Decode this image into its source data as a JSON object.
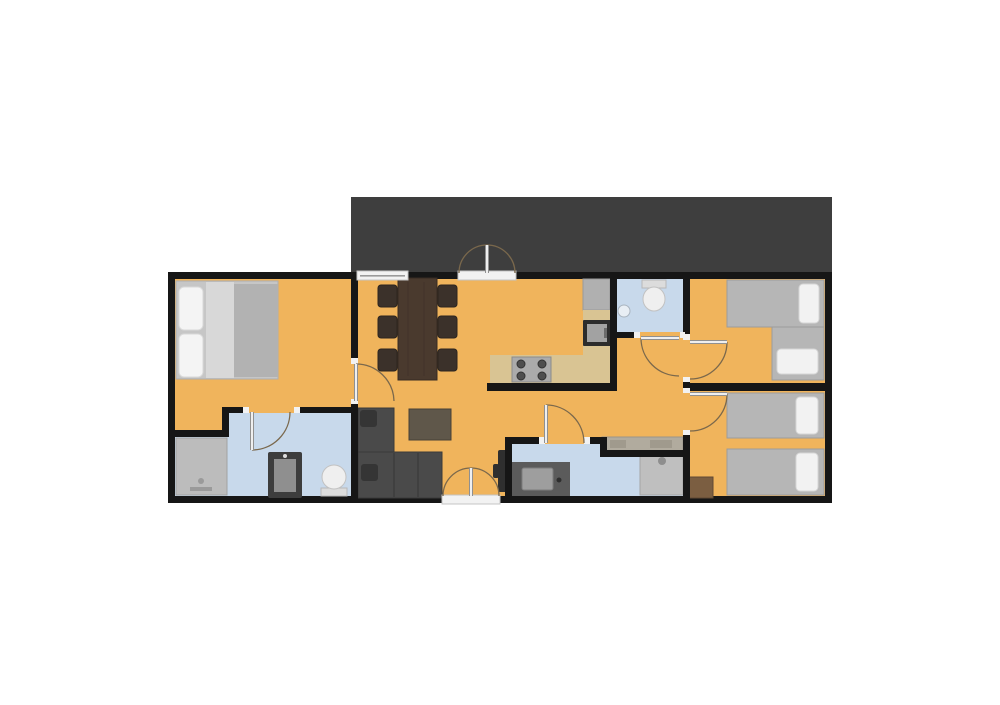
{
  "canvas": {
    "width": 1000,
    "height": 705,
    "background": "#ffffff"
  },
  "palette": {
    "wall": "#161616",
    "floor": "#f0b45c",
    "bathroom_floor": "#c8d9eb",
    "terrace": "#3e3e3e",
    "window": "#f2f2f2",
    "door_arc": "#7a684c",
    "door_leaf": "#efefef",
    "door_leaf_casing": "#909090",
    "bed_mattress": "#b6b6b6",
    "pillow": "#f2f2f2",
    "sofa": "#4a4a4a",
    "table_wood": "#4a3a2e",
    "counter": "#d9c493"
  },
  "base": [
    {
      "name": "terrace",
      "rect": [
        351,
        197,
        481,
        76
      ],
      "fill": "#3e3e3e"
    },
    {
      "name": "building-outline",
      "rect": [
        168,
        272,
        664,
        231
      ],
      "fill": "#161616"
    },
    {
      "name": "floor-main",
      "rect": [
        175,
        279,
        650,
        217
      ],
      "fill": "#f0b45c"
    },
    {
      "name": "floor-bathroom-left",
      "rect": [
        229,
        413,
        124,
        83
      ],
      "fill": "#c8d9eb"
    },
    {
      "name": "floor-bathroom-left-shower-area",
      "rect": [
        175,
        437,
        54,
        59
      ],
      "fill": "#c8d9eb"
    },
    {
      "name": "floor-bathroom-top",
      "rect": [
        617,
        279,
        66,
        53
      ],
      "fill": "#c8d9eb"
    },
    {
      "name": "floor-bathroom-bottom-left",
      "rect": [
        512,
        444,
        95,
        52
      ],
      "fill": "#c8d9eb"
    },
    {
      "name": "floor-bathroom-bottom-right",
      "rect": [
        607,
        457,
        76,
        39
      ],
      "fill": "#c8d9eb"
    }
  ],
  "walls": [
    [
      351,
      272,
      7,
      92
    ],
    [
      351,
      400,
      7,
      103
    ],
    [
      175,
      430,
      54,
      7
    ],
    [
      222,
      407,
      7,
      30
    ],
    [
      229,
      407,
      20,
      6
    ],
    [
      294,
      407,
      64,
      6
    ],
    [
      610,
      272,
      7,
      118
    ],
    [
      487,
      383,
      130,
      8
    ],
    [
      617,
      332,
      23,
      6
    ],
    [
      680,
      332,
      10,
      6
    ],
    [
      683,
      272,
      7,
      68
    ],
    [
      683,
      377,
      7,
      16
    ],
    [
      683,
      430,
      7,
      73
    ],
    [
      690,
      383,
      142,
      8
    ],
    [
      505,
      437,
      7,
      66
    ],
    [
      505,
      437,
      40,
      7
    ],
    [
      584,
      437,
      23,
      7
    ],
    [
      600,
      437,
      7,
      20
    ],
    [
      600,
      450,
      90,
      7
    ]
  ],
  "furniture": [
    {
      "name": "double-bed-frame",
      "rect": [
        176,
        281,
        102,
        98
      ],
      "fill": "#c6c6c6",
      "stroke": "#aeaeae"
    },
    {
      "name": "double-bed-sheet",
      "rect": [
        206,
        282,
        28,
        96
      ],
      "fill": "#d8d8d8"
    },
    {
      "name": "double-bed-blanket",
      "rect": [
        234,
        284,
        44,
        93
      ],
      "fill": "#b2b2b2"
    },
    {
      "name": "double-bed-pillow",
      "rect": [
        179,
        287,
        24,
        43
      ],
      "fill": "#f4f4f4",
      "stroke": "#d8d8d8",
      "rx": 5
    },
    {
      "name": "double-bed-pillow",
      "rect": [
        179,
        334,
        24,
        43
      ],
      "fill": "#f4f4f4",
      "stroke": "#d8d8d8",
      "rx": 5
    },
    {
      "name": "shower",
      "rect": [
        176,
        438,
        51,
        57
      ],
      "fill": "#bcbcbc",
      "stroke": "#a2a2a2"
    },
    {
      "name": "shower-faucet",
      "rect": [
        190,
        487,
        22,
        4
      ],
      "fill": "#9a9a9a"
    },
    {
      "name": "shower-drain",
      "circle": [
        201,
        481,
        3
      ],
      "fill": "#9a9a9a"
    },
    {
      "name": "washing-machine",
      "rect": [
        268,
        452,
        34,
        46
      ],
      "fill": "#3d3d3d",
      "rx": 2
    },
    {
      "name": "washing-machine-door",
      "rect": [
        274,
        459,
        22,
        33
      ],
      "fill": "#8f8f8f"
    },
    {
      "name": "washing-machine-knob",
      "circle": [
        285,
        456,
        2
      ],
      "fill": "#dddddd"
    },
    {
      "name": "toilet-tank",
      "rect": [
        321,
        488,
        26,
        8
      ],
      "fill": "#dcdcdc",
      "stroke": "#b8b8b8"
    },
    {
      "name": "toilet-bowl",
      "ellipse": [
        334,
        477,
        12,
        12
      ],
      "fill": "#efefef",
      "stroke": "#c2c2c2"
    },
    {
      "name": "dining-table",
      "rect": [
        398,
        278,
        39,
        102
      ],
      "fill": "#4a3a2e",
      "stroke": "#372b22"
    },
    {
      "name": "dining-table-grain",
      "line": [
        408,
        282,
        408,
        376
      ],
      "stroke": "#41332a",
      "sw": 1
    },
    {
      "name": "dining-table-grain",
      "line": [
        424,
        282,
        424,
        376
      ],
      "stroke": "#41332a",
      "sw": 1
    },
    {
      "name": "dining-chair",
      "rect": [
        378,
        285,
        19,
        22
      ],
      "fill": "#3b312a",
      "stroke": "#2c251f",
      "rx": 3
    },
    {
      "name": "dining-chair",
      "rect": [
        378,
        316,
        19,
        22
      ],
      "fill": "#3b312a",
      "stroke": "#2c251f",
      "rx": 3
    },
    {
      "name": "dining-chair",
      "rect": [
        378,
        349,
        19,
        22
      ],
      "fill": "#3b312a",
      "stroke": "#2c251f",
      "rx": 3
    },
    {
      "name": "dining-chair",
      "rect": [
        438,
        285,
        19,
        22
      ],
      "fill": "#3b312a",
      "stroke": "#2c251f",
      "rx": 3
    },
    {
      "name": "dining-chair",
      "rect": [
        438,
        316,
        19,
        22
      ],
      "fill": "#3b312a",
      "stroke": "#2c251f",
      "rx": 3
    },
    {
      "name": "dining-chair",
      "rect": [
        438,
        349,
        19,
        22
      ],
      "fill": "#3b312a",
      "stroke": "#2c251f",
      "rx": 3
    },
    {
      "name": "kitchen-fridge",
      "rect": [
        583,
        279,
        27,
        31
      ],
      "fill": "#b0b0b0",
      "stroke": "#9a9a9a"
    },
    {
      "name": "kitchen-counter-side",
      "rect": [
        583,
        310,
        27,
        73
      ],
      "fill": "#d9c493"
    },
    {
      "name": "kitchen-counter",
      "rect": [
        490,
        355,
        120,
        28
      ],
      "fill": "#d9c493"
    },
    {
      "name": "oven",
      "rect": [
        583,
        320,
        28,
        26
      ],
      "fill": "#2c2c2c",
      "rx": 1
    },
    {
      "name": "oven-door",
      "rect": [
        587,
        324,
        20,
        18
      ],
      "fill": "#a2a2a2"
    },
    {
      "name": "oven-handle",
      "rect": [
        604,
        328,
        3,
        10
      ],
      "fill": "#6b6b6b"
    },
    {
      "name": "stove",
      "rect": [
        512,
        357,
        39,
        25
      ],
      "fill": "#ababab",
      "stroke": "#8b8b8b"
    },
    {
      "name": "stove-burner",
      "circle": [
        521,
        364,
        4
      ],
      "fill": "#4e4e4e",
      "stroke": "#333333"
    },
    {
      "name": "stove-burner",
      "circle": [
        542,
        364,
        4
      ],
      "fill": "#4e4e4e",
      "stroke": "#333333"
    },
    {
      "name": "stove-burner",
      "circle": [
        521,
        376,
        4
      ],
      "fill": "#4e4e4e",
      "stroke": "#333333"
    },
    {
      "name": "stove-burner",
      "circle": [
        542,
        376,
        4
      ],
      "fill": "#4e4e4e",
      "stroke": "#333333"
    },
    {
      "name": "toilet-tank",
      "rect": [
        642,
        280,
        24,
        8
      ],
      "fill": "#dcdcdc",
      "stroke": "#b8b8b8"
    },
    {
      "name": "toilet-bowl",
      "ellipse": [
        654,
        299,
        11,
        12
      ],
      "fill": "#efefef",
      "stroke": "#c2c2c2"
    },
    {
      "name": "hand-basin",
      "circle": [
        624,
        311,
        6
      ],
      "fill": "#e8eef4",
      "stroke": "#a9b4bf"
    },
    {
      "name": "hall-counter",
      "rect": [
        602,
        437,
        81,
        15
      ],
      "fill": "#b1ab9e",
      "stroke": "#9a948a"
    },
    {
      "name": "hall-counter-item",
      "rect": [
        610,
        440,
        16,
        8
      ],
      "fill": "#a09a8d"
    },
    {
      "name": "hall-counter-item",
      "rect": [
        650,
        440,
        22,
        8
      ],
      "fill": "#a09a8d"
    },
    {
      "name": "vanity",
      "rect": [
        512,
        462,
        58,
        34
      ],
      "fill": "#5b5b5b"
    },
    {
      "name": "vanity-sink",
      "rect": [
        522,
        468,
        31,
        22
      ],
      "fill": "#9e9e9e",
      "stroke": "#7c7c7c",
      "rx": 2
    },
    {
      "name": "vanity-faucet",
      "circle": [
        559,
        480,
        2.5
      ],
      "fill": "#2e2e2e"
    },
    {
      "name": "shower",
      "rect": [
        640,
        455,
        43,
        40
      ],
      "fill": "#bfbfbf",
      "stroke": "#a5a5a5"
    },
    {
      "name": "shower-head",
      "circle": [
        662,
        461,
        4
      ],
      "fill": "#8e8e8e"
    },
    {
      "name": "tv",
      "rect": [
        498,
        450,
        12,
        42
      ],
      "fill": "#2f2f2f",
      "rx": 2
    },
    {
      "name": "tv-stand",
      "rect": [
        493,
        464,
        6,
        14
      ],
      "fill": "#2f2f2f",
      "rx": 2
    },
    {
      "name": "sofa-chaise",
      "rect": [
        358,
        408,
        36,
        90
      ],
      "fill": "#4a4a4a",
      "stroke": "#3a3a3a"
    },
    {
      "name": "sofa-seat",
      "rect": [
        358,
        452,
        84,
        46
      ],
      "fill": "#4a4a4a",
      "stroke": "#3a3a3a"
    },
    {
      "name": "sofa-cushion-line",
      "line": [
        394,
        453,
        394,
        497
      ],
      "stroke": "#3c3c3c",
      "sw": 1.5
    },
    {
      "name": "sofa-cushion-line",
      "line": [
        418,
        453,
        418,
        497
      ],
      "stroke": "#3c3c3c",
      "sw": 1.5
    },
    {
      "name": "sofa-pillow",
      "rect": [
        360,
        410,
        17,
        17
      ],
      "fill": "#353535",
      "rx": 3
    },
    {
      "name": "sofa-pillow",
      "rect": [
        361,
        464,
        17,
        17
      ],
      "fill": "#353535",
      "rx": 3
    },
    {
      "name": "coffee-table",
      "rect": [
        409,
        409,
        42,
        31
      ],
      "fill": "#5f574a",
      "stroke": "#474136"
    },
    {
      "name": "single-bed",
      "rect": [
        727,
        280,
        97,
        47
      ],
      "fill": "#b6b6b6",
      "stroke": "#9c9c9c"
    },
    {
      "name": "bed-pillow",
      "rect": [
        799,
        284,
        20,
        39
      ],
      "fill": "#f2f2f2",
      "stroke": "#d5d5d5",
      "rx": 4
    },
    {
      "name": "single-bed",
      "rect": [
        772,
        327,
        52,
        53
      ],
      "fill": "#b6b6b6",
      "stroke": "#9c9c9c"
    },
    {
      "name": "bed-pillow",
      "rect": [
        777,
        349,
        41,
        25
      ],
      "fill": "#f2f2f2",
      "stroke": "#d5d5d5",
      "rx": 4
    },
    {
      "name": "single-bed",
      "rect": [
        727,
        393,
        97,
        45
      ],
      "fill": "#b6b6b6",
      "stroke": "#9c9c9c"
    },
    {
      "name": "bed-pillow",
      "rect": [
        796,
        397,
        22,
        37
      ],
      "fill": "#f2f2f2",
      "stroke": "#d5d5d5",
      "rx": 4
    },
    {
      "name": "single-bed",
      "rect": [
        727,
        449,
        97,
        46
      ],
      "fill": "#b6b6b6",
      "stroke": "#9c9c9c"
    },
    {
      "name": "bed-pillow",
      "rect": [
        796,
        453,
        22,
        38
      ],
      "fill": "#f2f2f2",
      "stroke": "#d5d5d5",
      "rx": 4
    },
    {
      "name": "nightstand",
      "rect": [
        688,
        477,
        25,
        21
      ],
      "fill": "#7b5e41",
      "stroke": "#5f4833"
    }
  ],
  "openings": [
    {
      "name": "window",
      "rect": [
        357,
        271,
        51,
        9
      ],
      "fill": "#f2f2f2",
      "stroke": "#c4c4c4"
    },
    {
      "name": "window-pane-line",
      "rect": [
        360,
        275,
        45,
        1.6
      ],
      "fill": "#9a9a9a"
    },
    {
      "name": "door-threshold",
      "rect": [
        458,
        271,
        58,
        9
      ],
      "fill": "#f2f2f2",
      "stroke": "#c4c4c4"
    },
    {
      "name": "door-threshold",
      "rect": [
        442,
        495,
        58,
        9
      ],
      "fill": "#f2f2f2",
      "stroke": "#c4c4c4"
    },
    {
      "name": "door-jamb",
      "rect": [
        351,
        358,
        7,
        6
      ],
      "fill": "#f2f2f2"
    },
    {
      "name": "door-jamb",
      "rect": [
        351,
        399,
        7,
        5
      ],
      "fill": "#f2f2f2"
    },
    {
      "name": "door-jamb",
      "rect": [
        243,
        407,
        6,
        6
      ],
      "fill": "#f2f2f2"
    },
    {
      "name": "door-jamb",
      "rect": [
        294,
        407,
        6,
        6
      ],
      "fill": "#f2f2f2"
    },
    {
      "name": "door-jamb",
      "rect": [
        539,
        437,
        6,
        7
      ],
      "fill": "#f2f2f2"
    },
    {
      "name": "door-jamb",
      "rect": [
        584,
        437,
        6,
        7
      ],
      "fill": "#f2f2f2"
    },
    {
      "name": "door-jamb",
      "rect": [
        634,
        332,
        6,
        6
      ],
      "fill": "#f2f2f2"
    },
    {
      "name": "door-jamb",
      "rect": [
        680,
        332,
        5,
        6
      ],
      "fill": "#f2f2f2"
    },
    {
      "name": "door-jamb",
      "rect": [
        683,
        334,
        7,
        6
      ],
      "fill": "#f2f2f2"
    },
    {
      "name": "door-jamb",
      "rect": [
        683,
        377,
        7,
        5
      ],
      "fill": "#f2f2f2"
    },
    {
      "name": "door-jamb",
      "rect": [
        683,
        388,
        7,
        5
      ],
      "fill": "#f2f2f2"
    },
    {
      "name": "door-jamb",
      "rect": [
        683,
        430,
        7,
        5
      ],
      "fill": "#f2f2f2"
    }
  ],
  "doors": [
    {
      "name": "terrace-french-door",
      "leaf": [
        487,
        245,
        487,
        273
      ],
      "arc": "M459,273 A28,28 0 0 1 515,273"
    },
    {
      "name": "living-room-garden-door",
      "leaf": [
        471,
        468,
        471,
        496
      ],
      "arc": "M443,496 A28,28 0 0 1 499,496"
    },
    {
      "name": "bedroom-left-door",
      "leaf": [
        356,
        364,
        356,
        401
      ],
      "arc": "M356,364 A38,38 0 0 1 394,401"
    },
    {
      "name": "bathroom-left-door",
      "leaf": [
        252,
        412,
        252,
        450
      ],
      "arc": "M252,450 A38,38 0 0 0 290,412"
    },
    {
      "name": "bathroom-bottom-door",
      "leaf": [
        546,
        405,
        546,
        443
      ],
      "arc": "M546,405 A38,38 0 0 1 584,443"
    },
    {
      "name": "bathroom-top-door",
      "leaf": [
        641,
        338,
        679,
        338
      ],
      "arc": "M641,338 A38,38 0 0 0 679,376"
    },
    {
      "name": "bedroom-top-right-door",
      "leaf": [
        690,
        342,
        727,
        342
      ],
      "arc": "M727,342 A37,37 0 0 1 690,379"
    },
    {
      "name": "bedroom-bottom-right-door",
      "leaf": [
        690,
        394,
        727,
        394
      ],
      "arc": "M727,394 A37,37 0 0 1 690,431"
    }
  ]
}
